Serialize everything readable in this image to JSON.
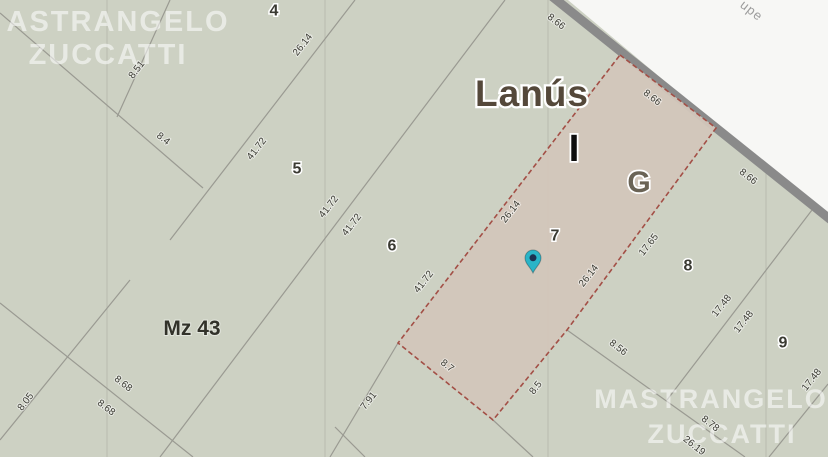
{
  "map": {
    "city_label": "Lanús",
    "section_letter_i": "I",
    "section_letter_g": "G",
    "block_label": "Mz 43",
    "street_name_fragment": "upe",
    "watermark_top_left_line1": "ASTRANGELO",
    "watermark_top_left_line2": "ZUCCATTI",
    "watermark_bottom_right_line1": "MASTRANGELO",
    "watermark_bottom_right_line2": "ZUCCATTI",
    "colors": {
      "background": "#cdd1c3",
      "street_fill": "#f7f7f5",
      "road_edge": "#8a8a8a",
      "highlight_parcel_fill": "#d2c6ba",
      "highlight_parcel_border": "#a34f46",
      "pin": "#2ab4c7",
      "pin_center": "#1d3150",
      "boundary_line": "#9a9a92"
    },
    "lot_numbers": [
      {
        "t": "4",
        "x": 274,
        "y": 11
      },
      {
        "t": "5",
        "x": 297,
        "y": 169
      },
      {
        "t": "6",
        "x": 392,
        "y": 246
      },
      {
        "t": "7",
        "x": 555,
        "y": 236
      },
      {
        "t": "8",
        "x": 688,
        "y": 266
      },
      {
        "t": "9",
        "x": 783,
        "y": 343
      }
    ],
    "dimension_labels": [
      {
        "t": "8.51",
        "x": 137,
        "y": 70,
        "r": -52
      },
      {
        "t": "8.4",
        "x": 163,
        "y": 139,
        "r": 38
      },
      {
        "t": "26.14",
        "x": 303,
        "y": 45,
        "r": -52
      },
      {
        "t": "41.72",
        "x": 257,
        "y": 149,
        "r": -52
      },
      {
        "t": "41.72",
        "x": 329,
        "y": 207,
        "r": -52
      },
      {
        "t": "41.72",
        "x": 352,
        "y": 225,
        "r": -52
      },
      {
        "t": "41.72",
        "x": 424,
        "y": 282,
        "r": -52
      },
      {
        "t": "26.14",
        "x": 511,
        "y": 212,
        "r": -52
      },
      {
        "t": "8.66",
        "x": 556,
        "y": 22,
        "r": 38
      },
      {
        "t": "8.66",
        "x": 652,
        "y": 98,
        "r": 38
      },
      {
        "t": "8.66",
        "x": 748,
        "y": 177,
        "r": 38
      },
      {
        "t": "26.14",
        "x": 589,
        "y": 276,
        "r": -52
      },
      {
        "t": "17.65",
        "x": 649,
        "y": 245,
        "r": -52
      },
      {
        "t": "17.48",
        "x": 722,
        "y": 306,
        "r": -52
      },
      {
        "t": "17.48",
        "x": 744,
        "y": 322,
        "r": -52
      },
      {
        "t": "17.48",
        "x": 812,
        "y": 380,
        "r": -52
      },
      {
        "t": "8.56",
        "x": 618,
        "y": 348,
        "r": 38
      },
      {
        "t": "8.7",
        "x": 447,
        "y": 366,
        "r": 38
      },
      {
        "t": "8.5",
        "x": 536,
        "y": 388,
        "r": -52
      },
      {
        "t": "7.91",
        "x": 369,
        "y": 401,
        "r": -52
      },
      {
        "t": "8.05",
        "x": 26,
        "y": 402,
        "r": -52
      },
      {
        "t": "8.68",
        "x": 123,
        "y": 384,
        "r": 38
      },
      {
        "t": "8.68",
        "x": 106,
        "y": 408,
        "r": 38
      },
      {
        "t": "8.78",
        "x": 710,
        "y": 424,
        "r": 38
      },
      {
        "t": "26.19",
        "x": 694,
        "y": 446,
        "r": 38
      }
    ]
  }
}
